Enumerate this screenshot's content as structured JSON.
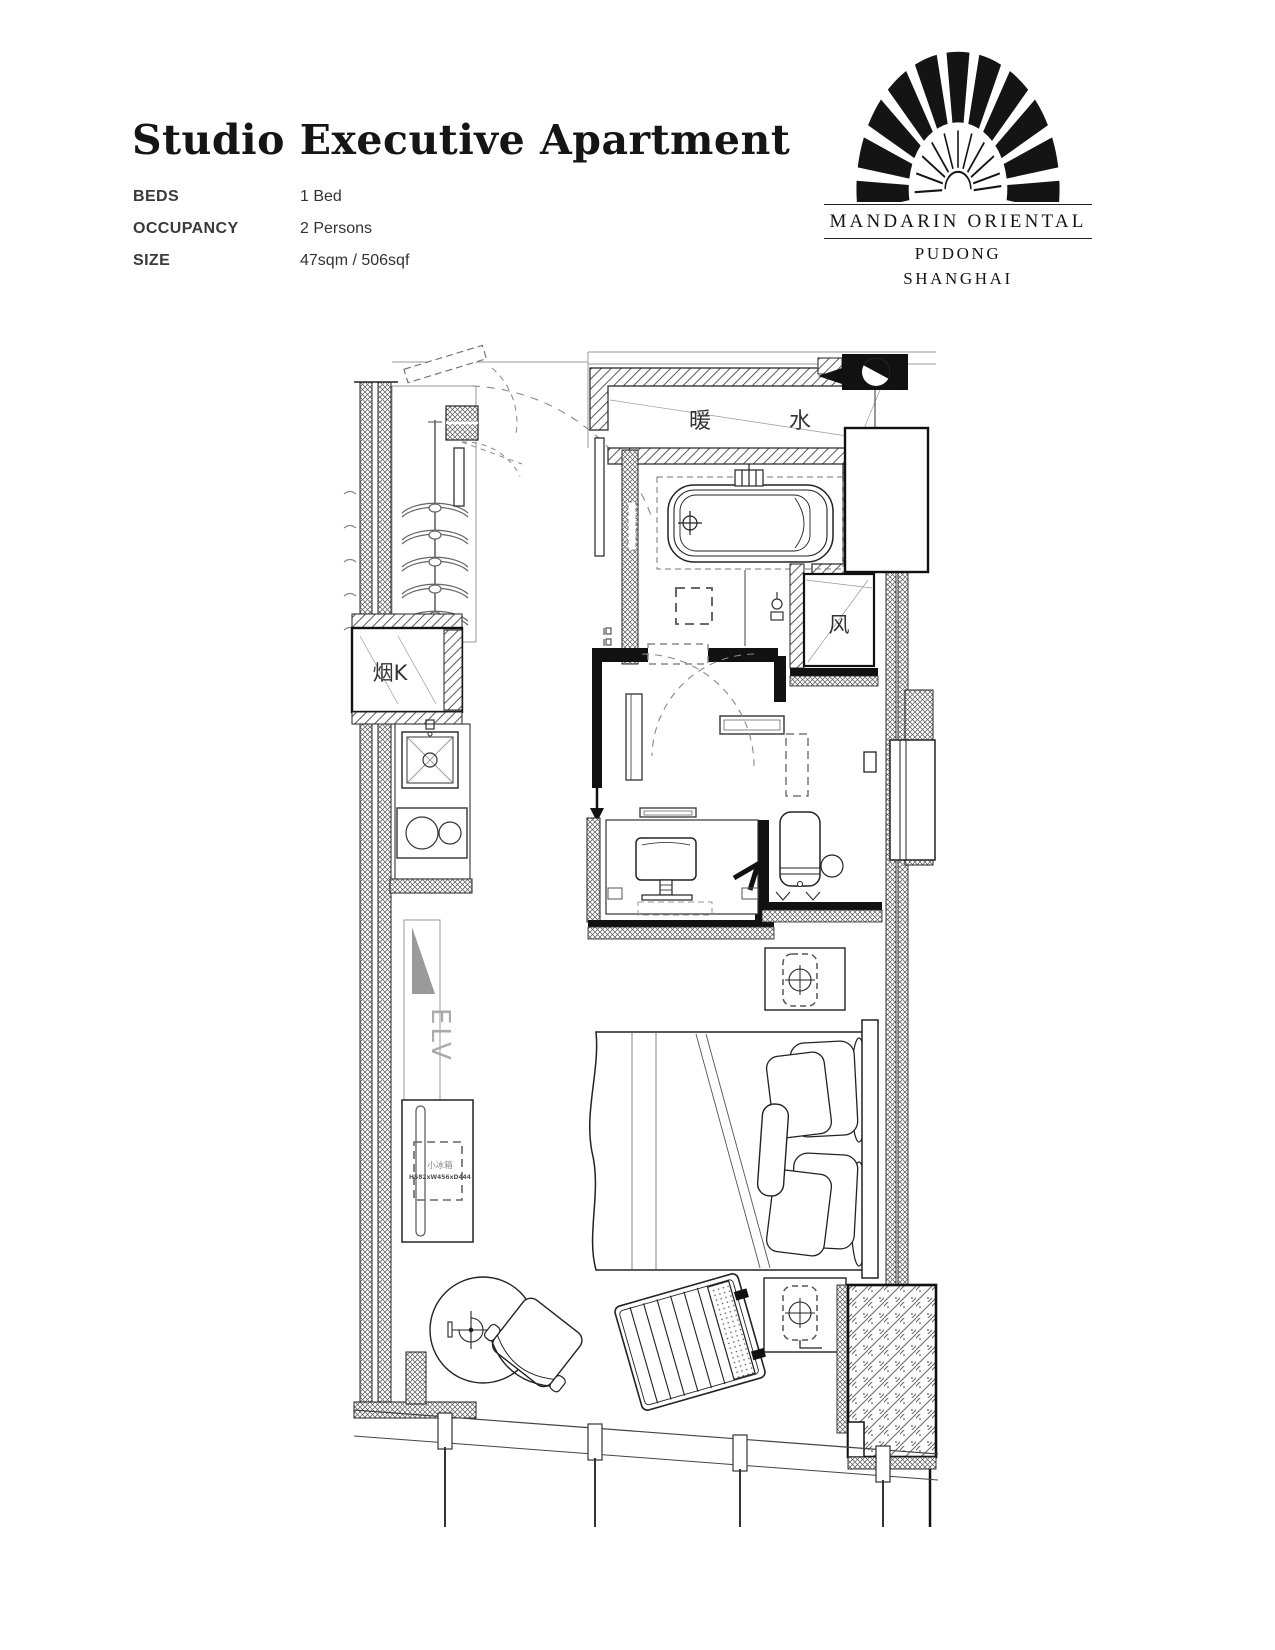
{
  "header": {
    "title": "Studio Executive Apartment",
    "specs": [
      {
        "label": "BEDS",
        "value": "1 Bed"
      },
      {
        "label": "OCCUPANCY",
        "value": "2 Persons"
      },
      {
        "label": "SIZE",
        "value": "47sqm / 506sqf"
      }
    ]
  },
  "logo": {
    "brand": "MANDARIN ORIENTAL",
    "city_line1": "PUDONG",
    "city_line2": "SHANGHAI",
    "fan_icon": "fan-icon",
    "ink_color": "#141414"
  },
  "floorplan": {
    "labels": {
      "duct_heating": "暖",
      "duct_water": "水",
      "air_shaft": "风",
      "kitchen_exhaust": "烟K",
      "elevator": "ELV",
      "minibar_name": "小冰箱",
      "minibar_dims": "H582xW456xD444"
    }
  }
}
